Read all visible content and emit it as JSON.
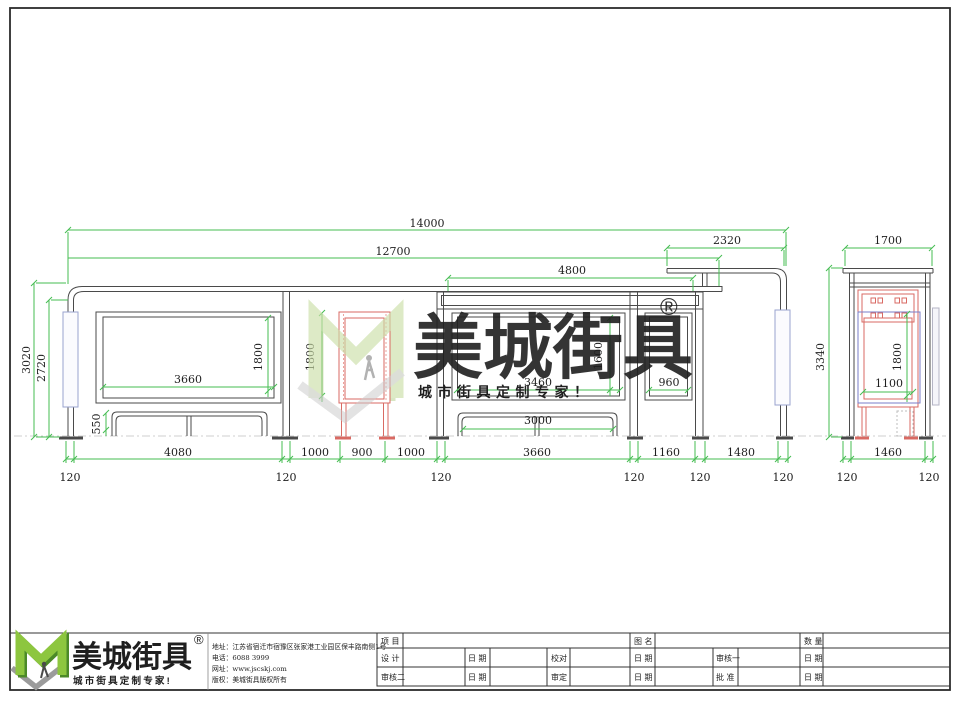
{
  "watermark": {
    "brand": "美城街具",
    "registered": "®",
    "tagline": "城市街具定制专家！"
  },
  "footer": {
    "brand": "美城街具",
    "registered": "®",
    "tagline": "城市街具定制专家!",
    "address": "地址：江苏省宿迁市宿豫区张家港工业园区保丰路南侧1号",
    "phone": "电话：6088 3999",
    "website": "网址：www.jscskj.com",
    "copyright": "版权：美城街具版权所有"
  },
  "titleblock": {
    "project": "项 目",
    "drawing_name": "图 名",
    "quantity": "数 量",
    "design": "设 计",
    "date": "日 期",
    "proofread": "校对",
    "reviewer1": "审核一",
    "reviewer2": "审核二",
    "approver": "审定",
    "ratify": "批 准"
  },
  "dims": {
    "total_width": "14000",
    "roof_main": "12700",
    "roof_ext": "2320",
    "sub_frame": "4800",
    "side_width": "1700",
    "height_total": "3020",
    "height_clear": "2720",
    "side_height": "3340",
    "panel1_w": "3660",
    "panel1_h": "1800",
    "bin_h": "1800",
    "panel2_w": "3460",
    "panel2_h": "1600",
    "panel3_w": "960",
    "bench_h": "550",
    "bench2_w": "3000",
    "side_panel_h": "1800",
    "side_panel_w": "1100",
    "bay1": "4080",
    "gap_left": "1000",
    "bin_w": "900",
    "gap_right": "1000",
    "bay2": "3660",
    "bay3": "1160",
    "bay4": "1480",
    "side_base": "1460",
    "pole_w": "120"
  },
  "colors": {
    "dim_green": "#46bd52",
    "structure": "#4a4a4a",
    "red_accent": "#d96a63",
    "blue_accent": "#9aa3cf",
    "logo_green_light": "#8dc63f",
    "logo_green_dark": "#4c8a28",
    "watermark_gray": "#c9c9c9"
  }
}
